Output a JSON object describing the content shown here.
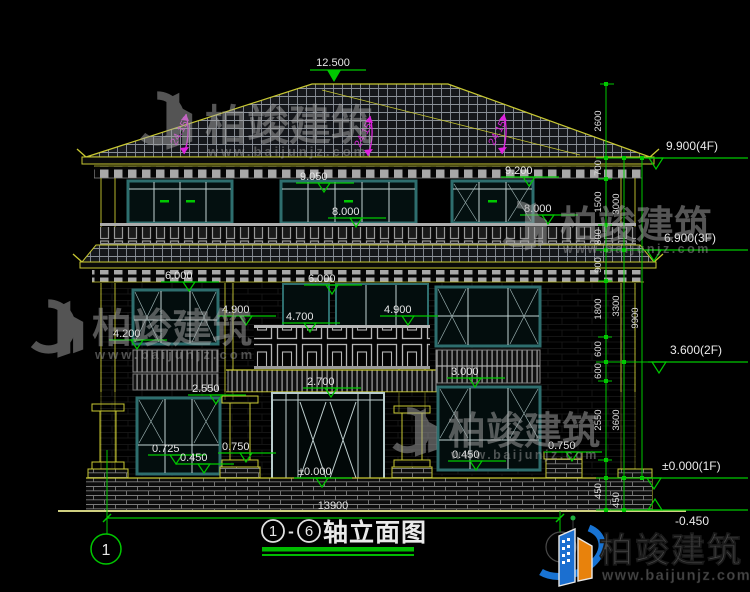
{
  "drawing": {
    "title": {
      "axis_start": "1",
      "axis_end": "6",
      "dash": "-",
      "label": "轴立面图"
    },
    "axis_bubble_left": "1",
    "total_width": "13900",
    "roof": {
      "ridge_elevation": "12.500",
      "slope": "24.15°"
    },
    "spot": {
      "e9050": "9.050",
      "e9200": "9.200",
      "e8000": "8.000",
      "e6000": "6.000",
      "e4900": "4.900",
      "e4700": "4.700",
      "e4200": "4.200",
      "e3000": "3.000",
      "e2700": "2.700",
      "e2550": "2.550",
      "e0750": "0.750",
      "e0725": "0.725",
      "e0450": "0.450",
      "e0000": "±0.000"
    },
    "flags": {
      "f4": "9.900(4F)",
      "f3": "6.900(3F)",
      "f2": "3.600(2F)",
      "f1": "±0.000(1F)",
      "fb": "-0.450"
    },
    "dims": {
      "fine": [
        "2600",
        "700",
        "1500",
        "800",
        "900",
        "1800",
        "600",
        "600",
        "2550",
        "450"
      ],
      "floor": [
        "3000",
        "3300",
        "3600",
        "450"
      ],
      "total": "9900"
    }
  },
  "watermark": {
    "name": "柏竣建筑",
    "url": "www.baijunjz.com"
  },
  "logo": {
    "name": "柏竣建筑",
    "url": "www.baijunjz.com"
  },
  "colors": {
    "background": "#000000",
    "cad_yellow": "#c8c832",
    "dim_green": "#00c800",
    "annotation_magenta": "#dd22dd",
    "window_teal": "#2e6e6e",
    "text_white": "#e6e6e6"
  }
}
